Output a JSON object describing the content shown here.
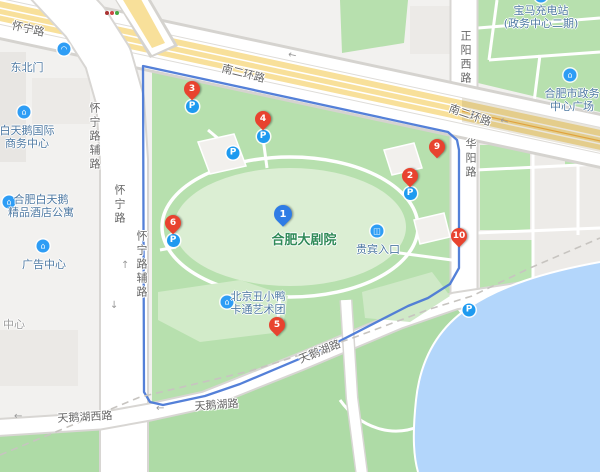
{
  "map": {
    "place_title": "合肥大剧院",
    "colors": {
      "water": "#b3d6fb",
      "park_green": "#b7e0ae",
      "park_green_light": "#dbeed3",
      "south_green": "#aedba6",
      "highway_yellow": "#f8e09a",
      "route_blue": "#4b79d6",
      "marker_red": "#e8432f",
      "marker_blue": "#2f7ce5",
      "parking_blue": "#1e9af0",
      "poi_text": "#4f7aa3",
      "road_text": "#666666",
      "theater_text": "#2f8a57"
    },
    "theater_label": {
      "text": "合肥大剧院",
      "x": 304,
      "y": 229
    },
    "markers": [
      {
        "num": "1",
        "x": 283,
        "y": 226,
        "color": "blue",
        "parking": false
      },
      {
        "num": "2",
        "x": 410,
        "y": 187,
        "color": "red",
        "parking": true
      },
      {
        "num": "3",
        "x": 192,
        "y": 100,
        "color": "red",
        "parking": true
      },
      {
        "num": "4",
        "x": 263,
        "y": 130,
        "color": "red",
        "parking": true
      },
      {
        "num": "5",
        "x": 277,
        "y": 336,
        "color": "red",
        "parking": false
      },
      {
        "num": "6",
        "x": 173,
        "y": 234,
        "color": "red",
        "parking": true
      },
      {
        "num": "9",
        "x": 437,
        "y": 158,
        "color": "red",
        "parking": false
      },
      {
        "num": "10",
        "x": 459,
        "y": 247,
        "color": "red",
        "parking": false
      }
    ],
    "parking_badge_label": "P",
    "parking_badges": [
      {
        "x": 233,
        "y": 153
      },
      {
        "x": 469,
        "y": 310
      }
    ],
    "pois": [
      {
        "name": "northeast-gate",
        "lines": [
          "东北门"
        ],
        "x": 27,
        "y": 61,
        "icon": {
          "name": "gate-icon",
          "glyph": "◠",
          "x": 64,
          "y": 49
        }
      },
      {
        "name": "swan-intl-business-center",
        "lines": [
          "白天鹅国际",
          "商务中心"
        ],
        "x": 27,
        "y": 124,
        "icon": {
          "name": "office-building-icon",
          "glyph": "⌂",
          "x": 24,
          "y": 112
        }
      },
      {
        "name": "swan-boutique-hotel",
        "lines": [
          "合肥白天鹅",
          "精品酒店公寓"
        ],
        "x": 41,
        "y": 193,
        "icon": {
          "name": "hotel-icon",
          "glyph": "⌂",
          "x": 9,
          "y": 202
        }
      },
      {
        "name": "ad-center",
        "lines": [
          "广告中心"
        ],
        "x": 44,
        "y": 258,
        "icon": {
          "name": "office-building-icon",
          "glyph": "⌂",
          "x": 43,
          "y": 246
        }
      },
      {
        "name": "partial-center-label",
        "lines": [
          "中心"
        ],
        "x": 14,
        "y": 318,
        "muted": true
      },
      {
        "name": "cartoon-art-troupe",
        "lines": [
          "北京丑小鸭",
          "卡通艺术团"
        ],
        "x": 258,
        "y": 290,
        "icon": {
          "name": "theater-building-icon",
          "glyph": "⌂",
          "x": 227,
          "y": 302
        }
      },
      {
        "name": "vip-entrance",
        "lines": [
          "贵宾入口"
        ],
        "x": 378,
        "y": 243,
        "icon": {
          "name": "entrance-icon",
          "glyph": "◫",
          "x": 377,
          "y": 231
        }
      },
      {
        "name": "bmw-charging-station",
        "lines": [
          "宝马充电站",
          "(政务中心二期)"
        ],
        "x": 541,
        "y": 4,
        "icon": {
          "name": "charging-station-icon",
          "glyph": "⚡",
          "x": 541,
          "y": -4
        }
      },
      {
        "name": "government-center-plaza",
        "lines": [
          "合肥市政务",
          "中心广场"
        ],
        "x": 572,
        "y": 87,
        "icon": {
          "name": "government-building-icon",
          "glyph": "⌂",
          "x": 570,
          "y": 75
        }
      }
    ],
    "road_labels": [
      {
        "text": "怀宁路",
        "x": 14,
        "y": 17,
        "rotate": 13
      },
      {
        "text": "怀宁路辅路",
        "x": 86,
        "y": 102,
        "vertical": true
      },
      {
        "text": "怀宁路",
        "x": 111,
        "y": 184,
        "vertical": true
      },
      {
        "text": "怀宁路辅路",
        "x": 133,
        "y": 230,
        "vertical": true
      },
      {
        "text": "南二环路",
        "x": 224,
        "y": 60,
        "rotate": 14
      },
      {
        "text": "南二环路",
        "x": 452,
        "y": 100,
        "rotate": 19
      },
      {
        "text": "正阳西路",
        "x": 457,
        "y": 30,
        "vertical": true
      },
      {
        "text": "华阳路",
        "x": 462,
        "y": 138,
        "vertical": true
      },
      {
        "text": "天鹅湖西路",
        "x": 57,
        "y": 410,
        "rotate": -3
      },
      {
        "text": "天鹅湖路",
        "x": 296,
        "y": 352,
        "rotate": -22
      },
      {
        "text": "天鹅湖路",
        "x": 194,
        "y": 398,
        "rotate": -4
      }
    ],
    "arrows": [
      {
        "glyph": "←",
        "x": 288,
        "y": 50,
        "rotate": 13
      },
      {
        "glyph": "←",
        "x": 500,
        "y": 116,
        "rotate": 19
      },
      {
        "glyph": "↑",
        "x": 121,
        "y": 260,
        "rotate": 0
      },
      {
        "glyph": "↓",
        "x": 110,
        "y": 300,
        "rotate": 0
      },
      {
        "glyph": "←",
        "x": 14,
        "y": 411,
        "rotate": 0
      },
      {
        "glyph": "←",
        "x": 156,
        "y": 403,
        "rotate": 0
      }
    ]
  }
}
